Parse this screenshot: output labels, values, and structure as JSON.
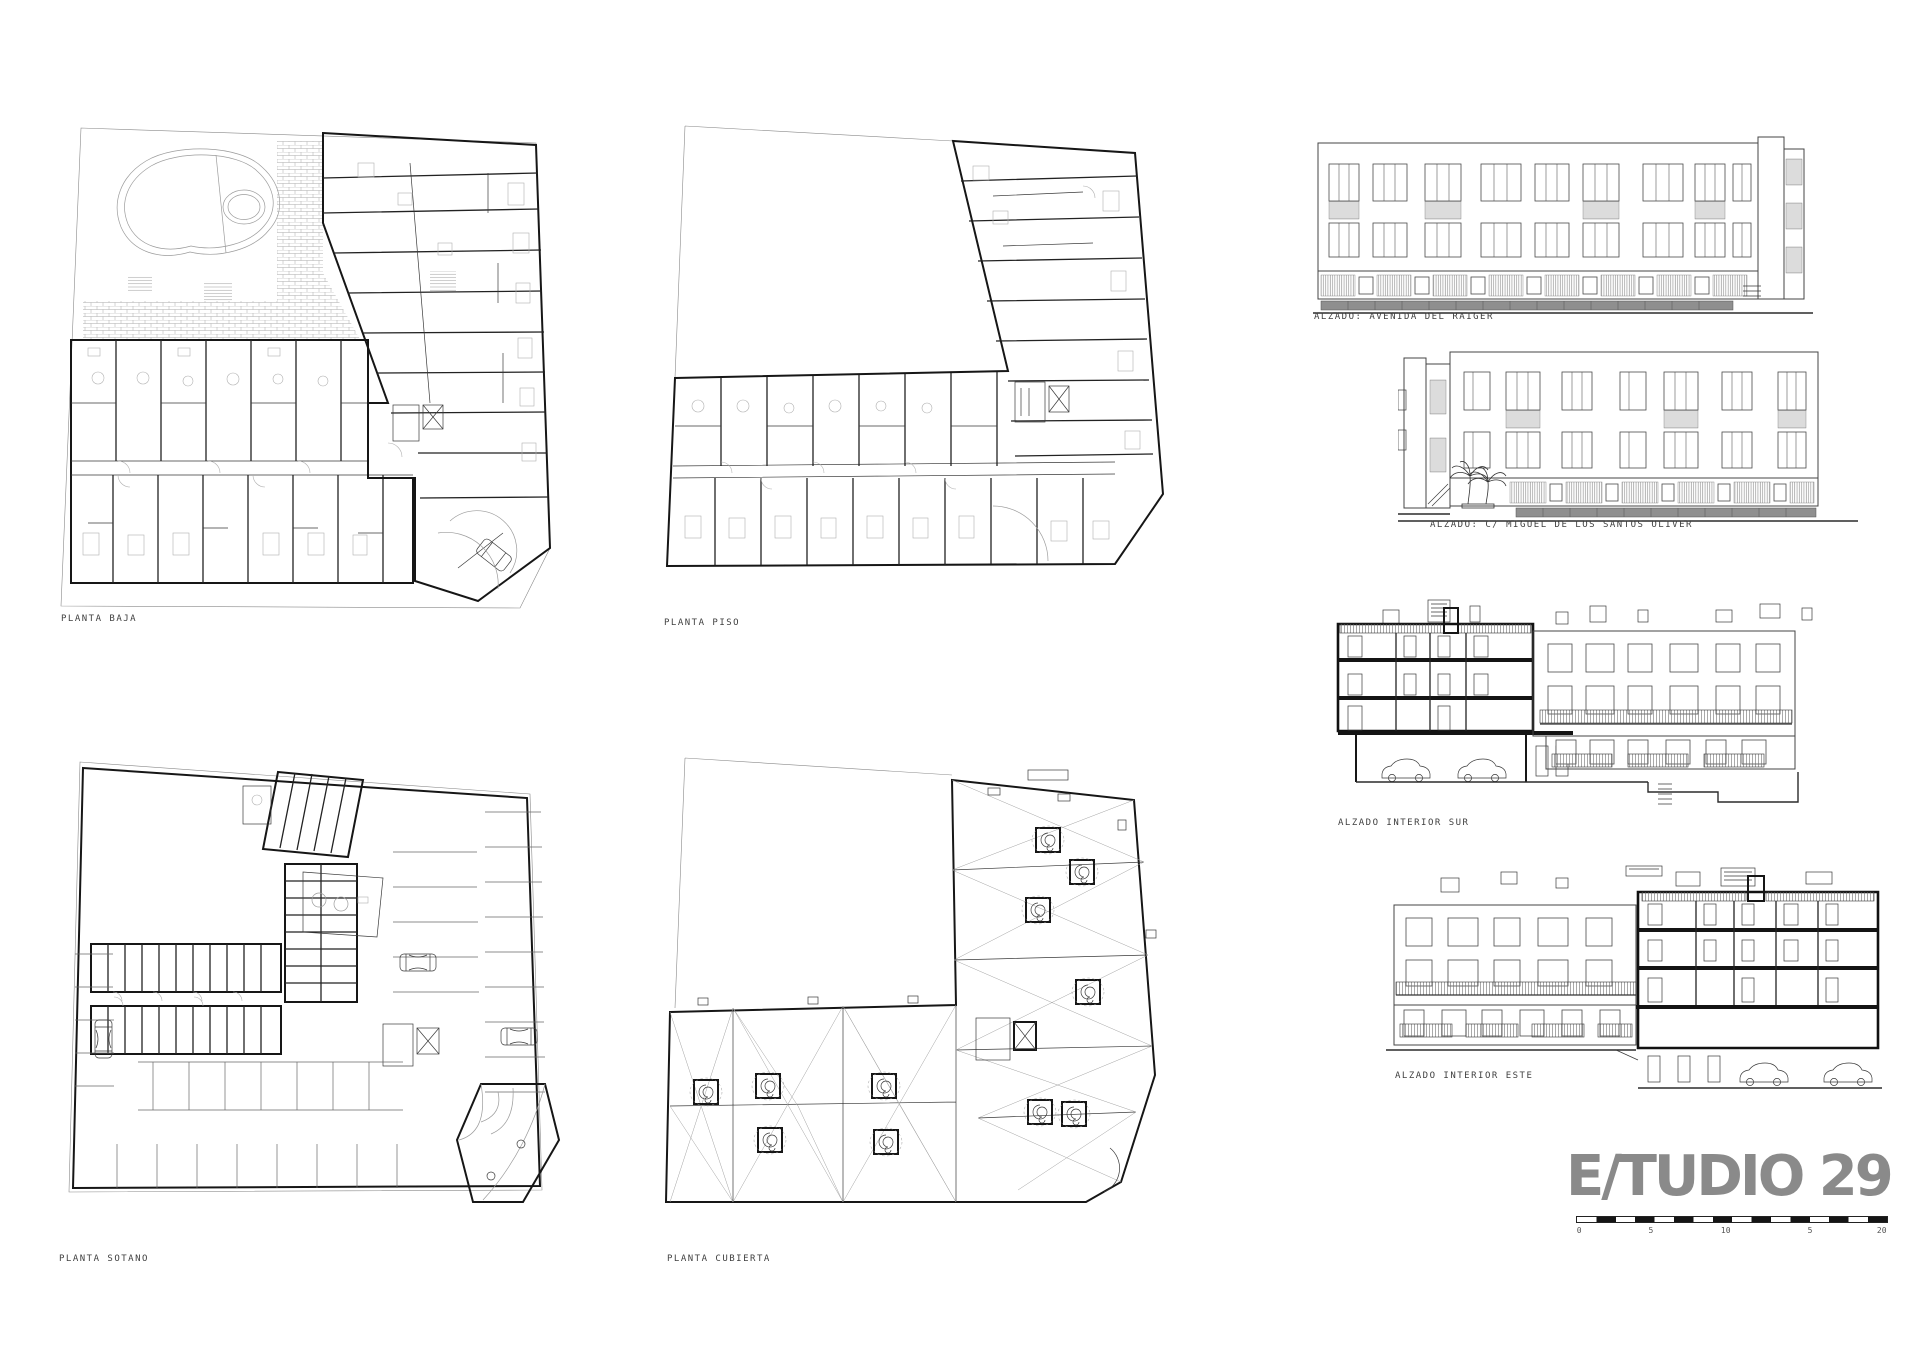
{
  "drawings": {
    "planta_baja": {
      "label": "PLANTA BAJA"
    },
    "planta_piso": {
      "label": "PLANTA PISO"
    },
    "planta_sotano": {
      "label": "PLANTA SOTANO"
    },
    "planta_cubierta": {
      "label": "PLANTA CUBIERTA"
    },
    "alzado_avenida": {
      "label": "ALZADO: AVENIDA DEL RAIGER"
    },
    "alzado_miguel": {
      "label": "ALZADO: C/ MIGUEL DE LOS SANTOS OLIVER"
    },
    "alzado_interior_sur": {
      "label": "ALZADO INTERIOR SUR"
    },
    "alzado_interior_este": {
      "label": "ALZADO INTERIOR ESTE"
    }
  },
  "logo": {
    "text": "E/TUDIO 29"
  },
  "scalebar": {
    "labels": [
      "0",
      "5",
      "10",
      "5",
      "20"
    ]
  },
  "colors": {
    "ink": "#1c1c1c",
    "light_line": "#aaaaaa",
    "fence_gray": "#8f8f8f",
    "logo_gray": "#8a8a8a"
  }
}
